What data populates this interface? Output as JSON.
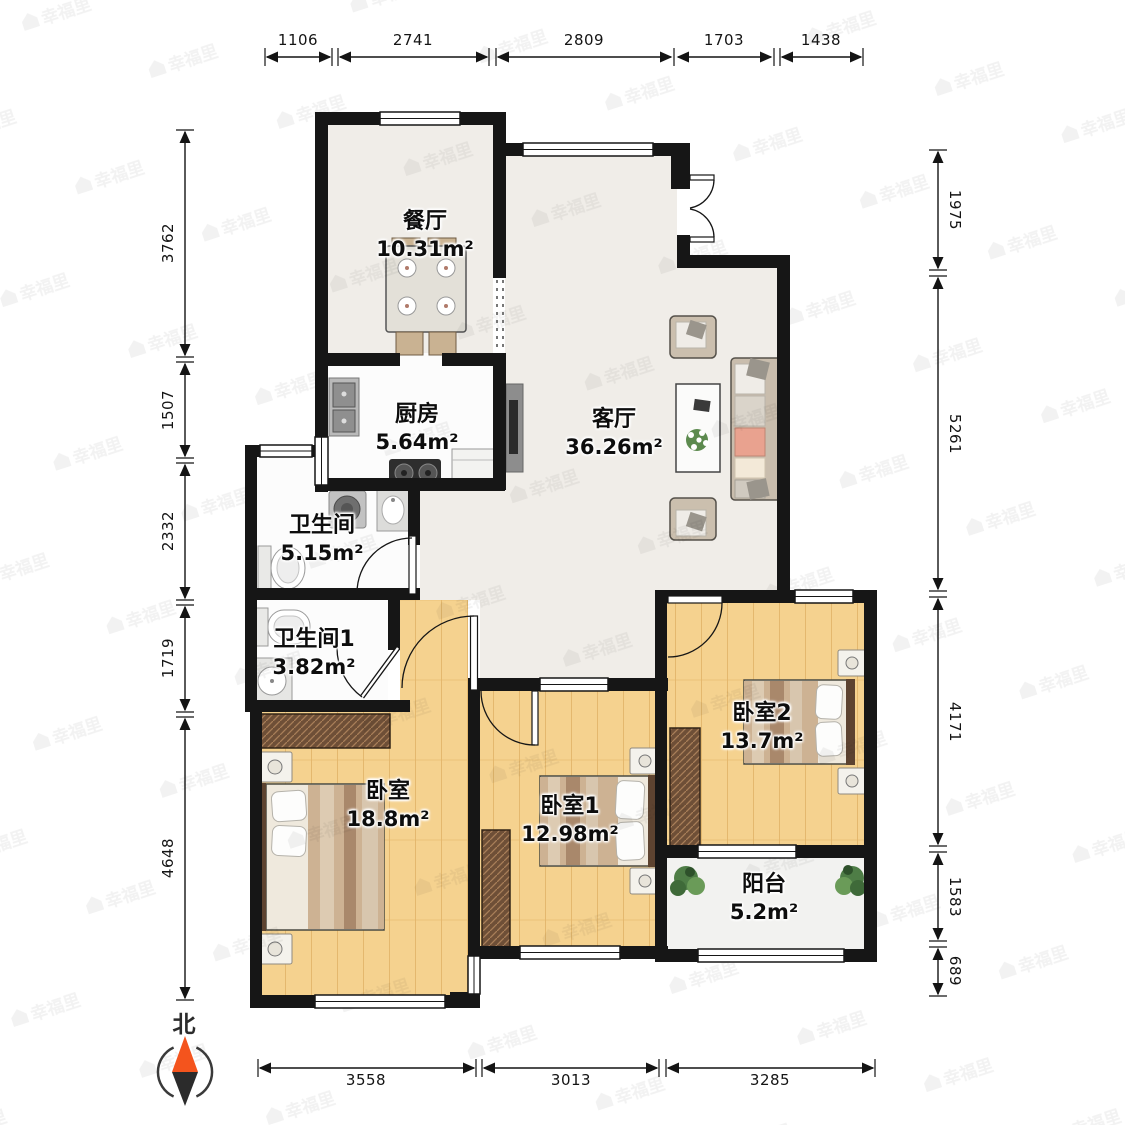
{
  "plan": {
    "rooms": [
      {
        "id": "dining",
        "name": "餐厅",
        "area": "10.31m²"
      },
      {
        "id": "kitchen",
        "name": "厨房",
        "area": "5.64m²"
      },
      {
        "id": "living",
        "name": "客厅",
        "area": "36.26m²"
      },
      {
        "id": "bath",
        "name": "卫生间",
        "area": "5.15m²"
      },
      {
        "id": "bath1",
        "name": "卫生间1",
        "area": "3.82m²"
      },
      {
        "id": "bedroom",
        "name": "卧室",
        "area": "18.8m²"
      },
      {
        "id": "bedroom1",
        "name": "卧室1",
        "area": "12.98m²"
      },
      {
        "id": "bedroom2",
        "name": "卧室2",
        "area": "13.7m²"
      },
      {
        "id": "balcony",
        "name": "阳台",
        "area": "5.2m²"
      }
    ]
  },
  "dimensions": {
    "top": [
      "1106",
      "2741",
      "2809",
      "1703",
      "1438"
    ],
    "bottom": [
      "3558",
      "3013",
      "3285"
    ],
    "left": [
      "3762",
      "1507",
      "2332",
      "1719",
      "4648"
    ],
    "right": [
      "1975",
      "5261",
      "4171",
      "1583",
      "689"
    ]
  },
  "compass": {
    "north_label": "北"
  },
  "watermark": {
    "text": "幸福里"
  },
  "colors": {
    "wall": "#161616",
    "wood_floor": "#f5d28f",
    "marble_floor": "#f0ede8",
    "white_floor": "#fcfcfc",
    "balcony_floor": "#f2f2f0",
    "compass_north": "#f4541d"
  }
}
